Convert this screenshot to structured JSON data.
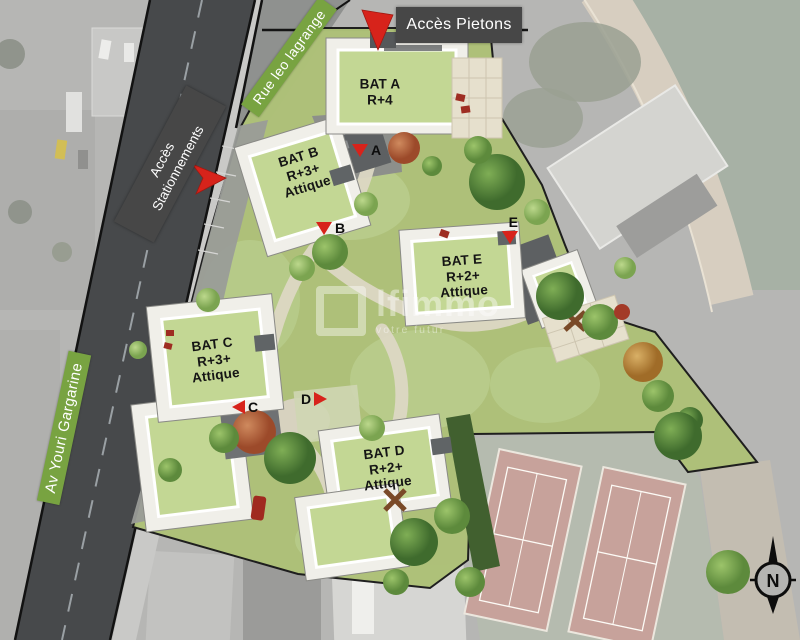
{
  "streets": {
    "av_youri": "Av Youri Gargarine",
    "rue_leo": "Rue leo lagrange"
  },
  "access": {
    "pietons": "Accès Pietons",
    "stationnements_l1": "Accès",
    "stationnements_l2": "Stationnements"
  },
  "buildings": [
    {
      "name": "BAT A",
      "line2": "R+4",
      "line3": ""
    },
    {
      "name": "BAT B",
      "line2": "R+3+",
      "line3": "Attique"
    },
    {
      "name": "BAT C",
      "line2": "R+3+",
      "line3": "Attique"
    },
    {
      "name": "BAT D",
      "line2": "R+2+",
      "line3": "Attique"
    },
    {
      "name": "BAT E",
      "line2": "R+2+",
      "line3": "Attique"
    }
  ],
  "markers": [
    {
      "letter": "A"
    },
    {
      "letter": "B"
    },
    {
      "letter": "C"
    },
    {
      "letter": "D"
    },
    {
      "letter": "E"
    }
  ],
  "compass": {
    "north": "N"
  },
  "watermark": {
    "name": "lfimmo",
    "tagline": "votre futur"
  },
  "colors": {
    "street_label_green": "#78a341",
    "access_label_gray": "#474747",
    "marker_red": "#d7231b",
    "lawn_green": "#aec178",
    "roof_green": "#c3d794"
  }
}
